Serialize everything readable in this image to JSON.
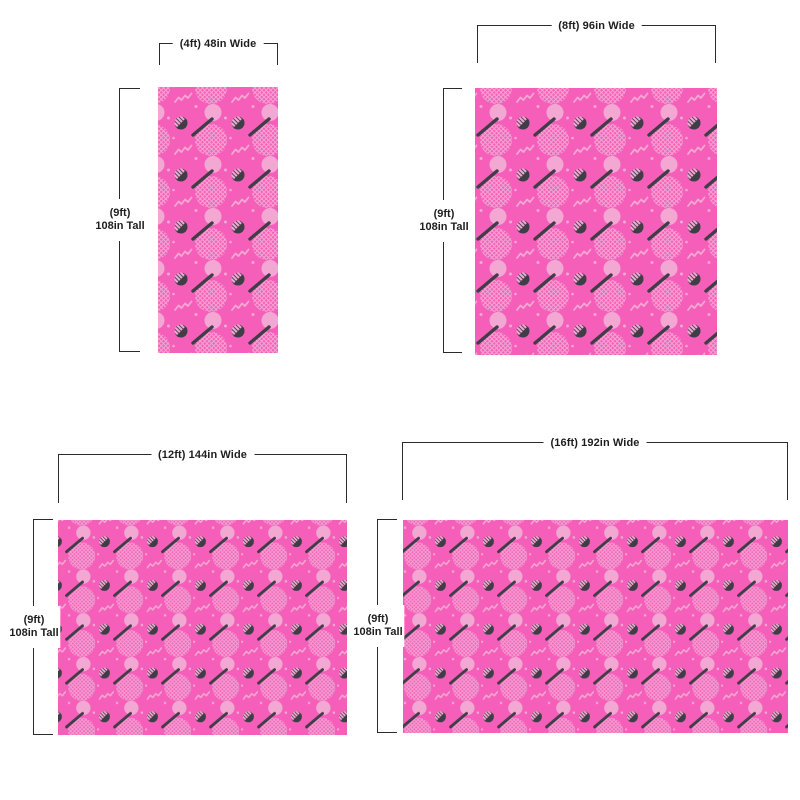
{
  "pattern": {
    "name": "pink-memphis-pattern",
    "background_color": "#F55FB9",
    "light_accent_color": "#F3A8D4",
    "dark_accent_color": "#403D47",
    "motifs": [
      "crosshatched-circle",
      "solid-circle",
      "half-moon",
      "diagonal-dash",
      "squiggle",
      "dot"
    ]
  },
  "annotation": {
    "line_color": "#2b2b2b",
    "text_color": "#1e1e1e"
  },
  "panels": [
    {
      "size_name": "4ft",
      "width_label": "(4ft) 48in Wide",
      "height_label_line1": "(9ft)",
      "height_label_line2": "108in Tall"
    },
    {
      "size_name": "8ft",
      "width_label": "(8ft) 96in Wide",
      "height_label_line1": "(9ft)",
      "height_label_line2": "108in Tall"
    },
    {
      "size_name": "12ft",
      "width_label": "(12ft) 144in Wide",
      "height_label_line1": "(9ft)",
      "height_label_line2": "108in Tall"
    },
    {
      "size_name": "16ft",
      "width_label": "(16ft) 192in Wide",
      "height_label_line1": "(9ft)",
      "height_label_line2": "108in Tall"
    }
  ]
}
